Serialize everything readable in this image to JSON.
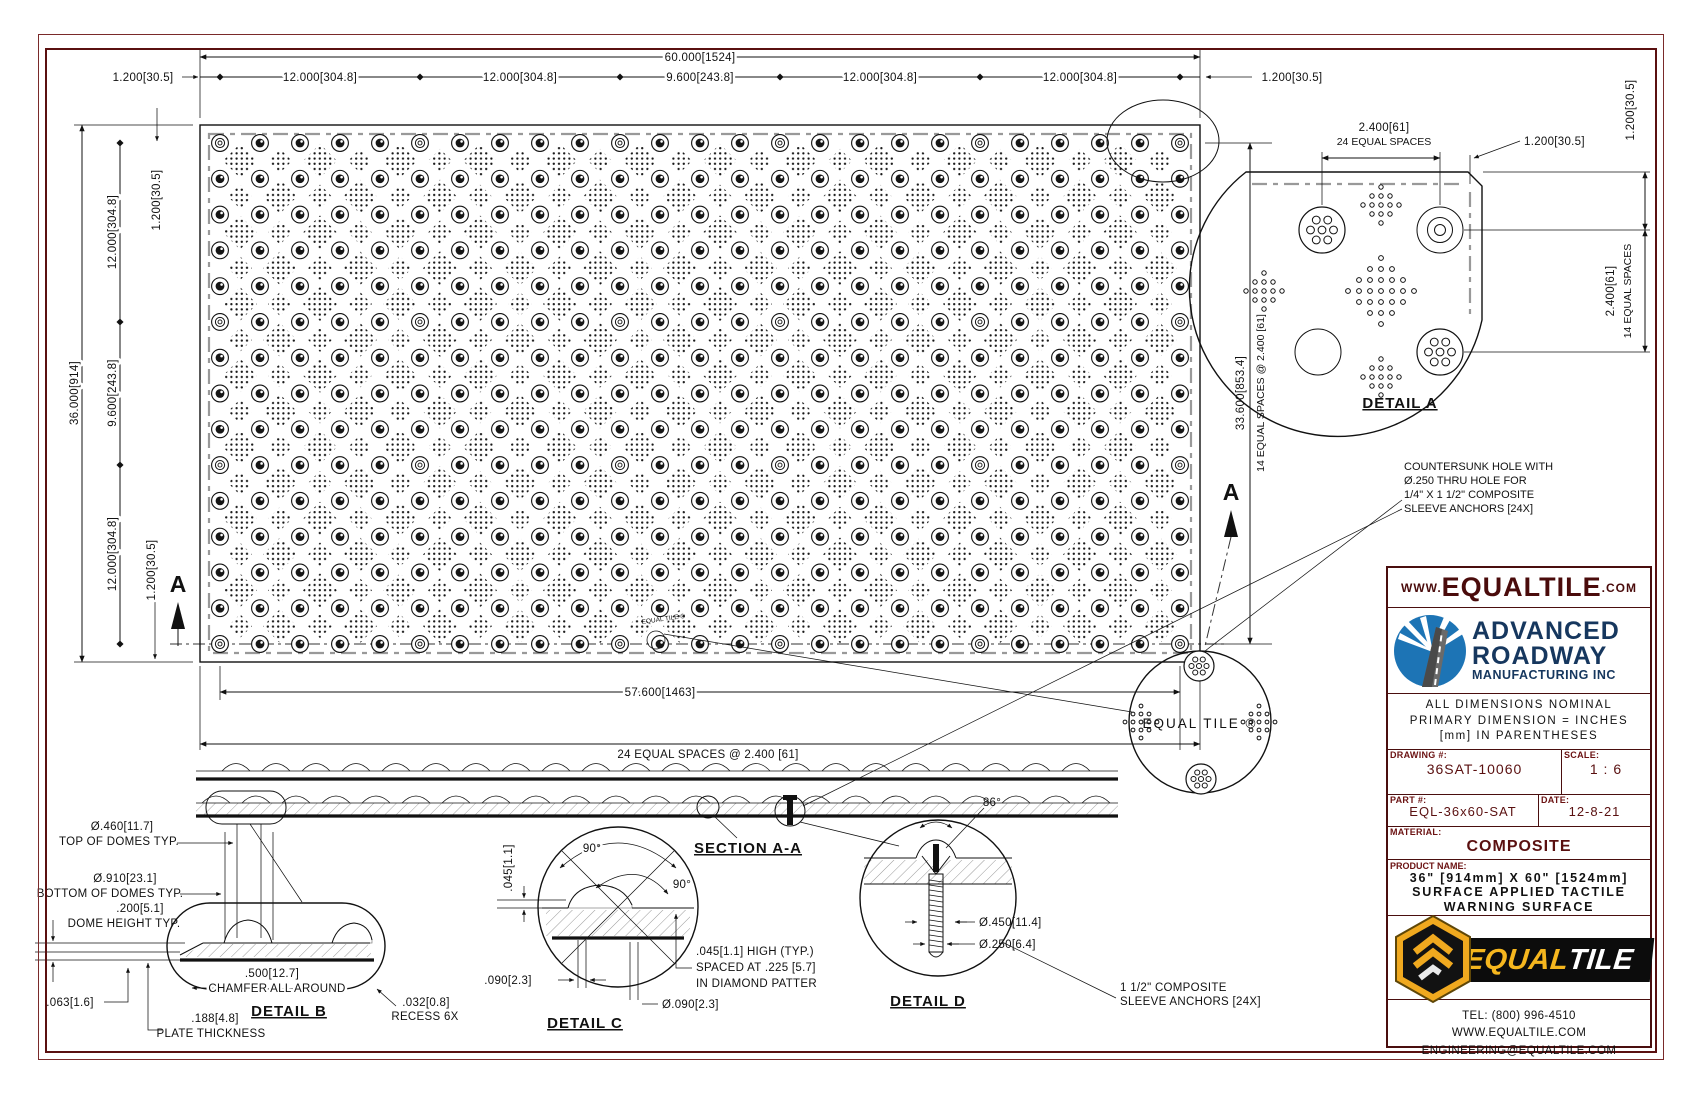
{
  "plan": {
    "cols": 25,
    "rows": 15,
    "anchor_cols": [
      0,
      5,
      10,
      14,
      19,
      24
    ],
    "anchor_rows": [
      0,
      5,
      9,
      14
    ],
    "engraving": "EQUAL TILE ®"
  },
  "dims_top": {
    "overall": "60.000[1524]",
    "seg1": "12.000[304.8]",
    "seg2": "12.000[304.8]",
    "seg3": "9.600[243.8]",
    "seg4": "12.000[304.8]",
    "seg5": "12.000[304.8]",
    "margin_left": "1.200[30.5]",
    "margin_right": "1.200[30.5]"
  },
  "dims_left": {
    "overall": "36.000[914]",
    "seg1": "12.000[304.8]",
    "seg2": "9.600[243.8]",
    "seg3": "12.000[304.8]",
    "margin_top": "1.200[30.5]",
    "margin_bottom": "1.200[30.5]"
  },
  "dims_right": {
    "overall": "33.600[853.4]",
    "spaces": "14 EQUAL SPACES @ 2.400 [61]"
  },
  "dims_bottom": {
    "overall": "57.600[1463]",
    "spaces": "24 EQUAL SPACES @ 2.400 [61]"
  },
  "section": {
    "label": "SECTION A-A",
    "mark": "A"
  },
  "countersunk_note": {
    "l1": "COUNTERSUNK HOLE WITH",
    "l2": "Ø.250 THRU HOLE FOR",
    "l3": "1/4\" X 1 1/2\" COMPOSITE",
    "l4": "SLEEVE ANCHORS [24X]"
  },
  "detail_a": {
    "title": "DETAIL A",
    "spaces_h1": "2.400[61]",
    "spaces_h2": "24 EQUAL SPACES",
    "margin_h": "1.200[30.5]",
    "margin_v": "1.200[30.5]",
    "spaces_v1": "2.400[61]",
    "spaces_v2": "14 EQUAL SPACES"
  },
  "detail_b": {
    "title": "DETAIL B",
    "top_dia": "Ø.460[11.7]",
    "top_label": "TOP OF DOMES TYP.",
    "bottom_dia": "Ø.910[23.1]",
    "bottom_label": "BOTTOM OF DOMES TYP.",
    "height": ".200[5.1]",
    "height_label": "DOME HEIGHT TYP.",
    "chamfer": ".500[12.7]",
    "chamfer_label": "CHAMFER ALL AROUND",
    "mat": ".063[1.6]",
    "plate": ".188[4.8]",
    "plate_label": "PLATE THICKNESS",
    "recess": ".032[0.8]",
    "recess_label": "RECESS 6X"
  },
  "detail_c": {
    "title": "DETAIL C",
    "angle1": "90°",
    "angle2": "90°",
    "serration_h": ".045[1.1]",
    "spacing1": ".090[2.3]",
    "spacing2": "Ø.090[2.3]",
    "note1": ".045[1.1] HIGH (TYP.)",
    "note2": "SPACED AT .225 [5.7]",
    "note3": "IN DIAMOND PATTER"
  },
  "detail_d": {
    "title": "DETAIL D",
    "angle": "86°",
    "dia1": "Ø.450[11.4]",
    "dia2": "Ø.250[6.4]",
    "note1": "1 1/2\" COMPOSITE",
    "note2": "SLEEVE ANCHORS [24X]"
  },
  "engraving_detail": {
    "text": "EQUAL TILE ®"
  },
  "title_block": {
    "website_pre": "WWW.",
    "website_main": "EQUALTILE",
    "website_suf": ".COM",
    "company_line1": "ADVANCED",
    "company_line2": "ROADWAY",
    "company_line3": "MANUFACTURING INC",
    "note1": "ALL DIMENSIONS NOMINAL",
    "note2": "PRIMARY DIMENSION = INCHES",
    "note3": "[mm] IN PARENTHESES",
    "drawing_label": "DRAWING #:",
    "drawing_value": "36SAT-10060",
    "scale_label": "SCALE:",
    "scale_value": "1 : 6",
    "part_label": "PART #:",
    "part_value": "EQL-36x60-SAT",
    "date_label": "DATE:",
    "date_value": "12-8-21",
    "material_label": "MATERIAL:",
    "material_value": "COMPOSITE",
    "product_label": "PRODUCT NAME:",
    "product_line1": "36\" [914mm] X 60\" [1524mm]",
    "product_line2": "SURFACE APPLIED TACTILE",
    "product_line3": "WARNING SURFACE",
    "brand_equal": "EQUAL",
    "brand_tile": "TILE",
    "tel": "TEL: (800) 996-4510",
    "web": "WWW.EQUALTILE.COM",
    "email": "ENGINEERING@EQUALTILE.COM",
    "colors": {
      "maroon": "#5a1010",
      "navy": "#16375e",
      "blue": "#1d74b5",
      "yellow": "#f0a91f"
    }
  }
}
